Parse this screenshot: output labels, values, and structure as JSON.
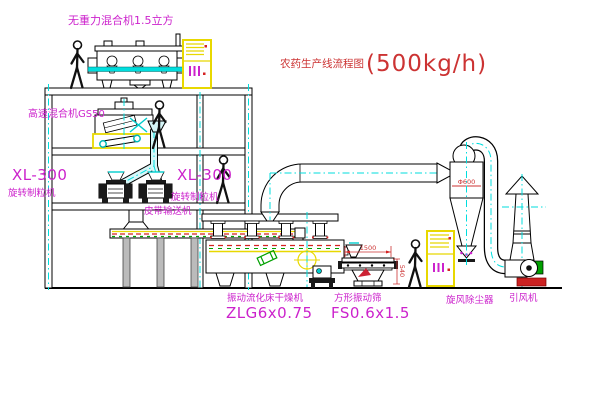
{
  "diagram": {
    "title": {
      "name": "农药生产线流程图",
      "capacity": "(500kg/h)"
    },
    "equipment_labels": {
      "gravity_mixer": "无重力混合机1.5立方",
      "high_speed_mixer": "高速混合机GS50",
      "granulator_left": {
        "model": "XL-300",
        "name": "旋转制粒机"
      },
      "granulator_right": {
        "model": "XL-300",
        "name": "旋转制粒机"
      },
      "belt_conveyor": "皮带输送机",
      "fluid_bed_dryer": {
        "name": "振动流化床干燥机",
        "model": "ZLG6x0.75"
      },
      "square_sieve": {
        "name": "方形振动筛",
        "model": "FS0.6x1.5"
      },
      "cyclone": "旋风除尘器",
      "induced_draft_fan": "引风机"
    },
    "dimensions": {
      "sieve_length": "1500",
      "sieve_height": "540",
      "cyclone_note": "Φ600"
    },
    "colors": {
      "label_magenta": "#cc22cc",
      "title_red": "#cc3333",
      "cabinet_yellow": "#e8d800",
      "pipe_cyan": "#00dede",
      "machine_green": "#00a000"
    }
  }
}
